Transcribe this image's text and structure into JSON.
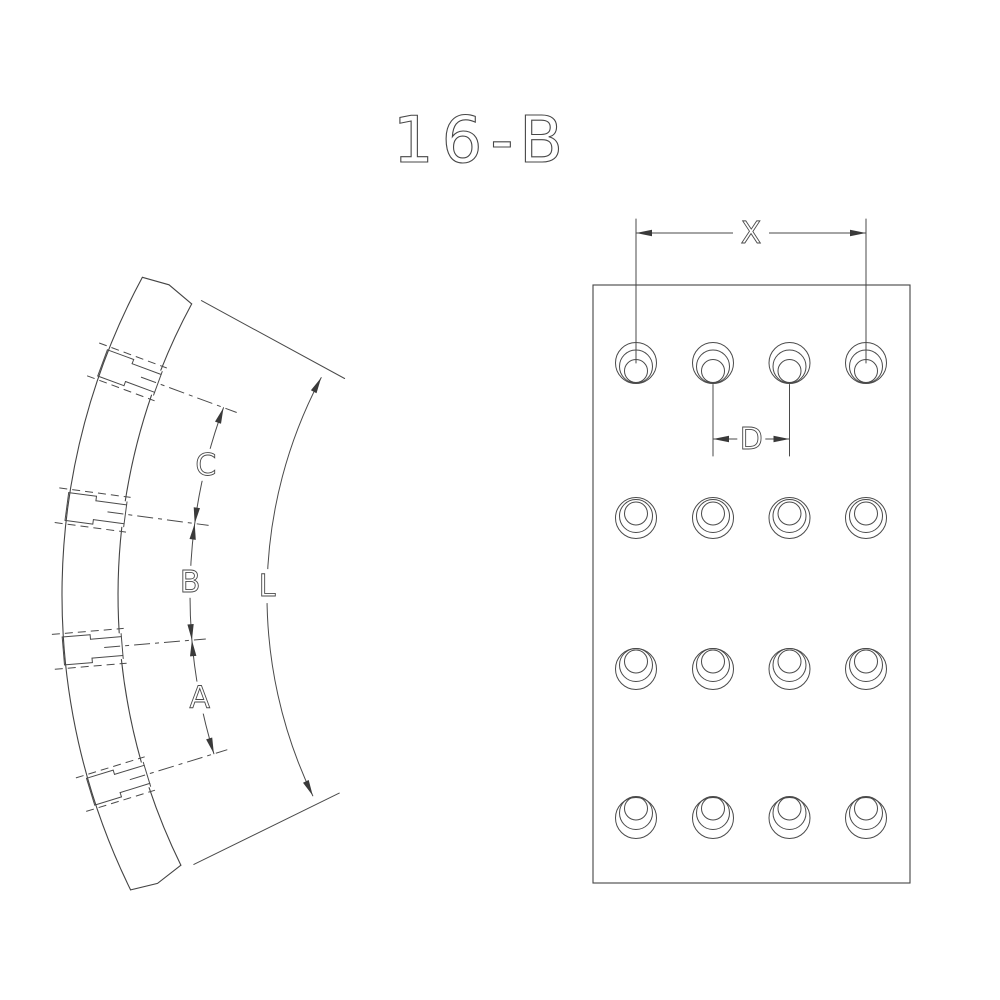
{
  "title": "16-B",
  "colors": {
    "line": "#4a4a4a",
    "arrow": "#3a3a3a",
    "background": "#ffffff"
  },
  "left_view": {
    "dim_chain": {
      "labels": [
        "C",
        "B",
        "A"
      ]
    },
    "length_dim": {
      "label": "L"
    },
    "geometry": {
      "center": [
        730,
        595
      ],
      "outer_radius": 668,
      "inner_radius": 612,
      "start_angle_deg": 153.8,
      "end_angle_deg": 208.4,
      "hole_angles_deg": [
        200.3,
        187.6,
        175.2,
        162.9
      ],
      "dim_chain_radius": 540,
      "length_dim_radius": 463,
      "counterbore_half_width": 14,
      "hole_half_width": 9.5,
      "hidden_line_half_width": 17.5,
      "step_radius": 641,
      "cap_radius": 610
    }
  },
  "right_view": {
    "dim_x": {
      "label": "X",
      "line_y": 233,
      "ext_top_y": 219
    },
    "dim_d": {
      "label": "D",
      "line_y": 439,
      "ext_bottom_y": 456
    },
    "geometry": {
      "rect": [
        593,
        285,
        317,
        598
      ],
      "columns_x": [
        636,
        713,
        789.5,
        866
      ],
      "rows_y": [
        363,
        518,
        669,
        818
      ],
      "hole_outer_r": 20.5,
      "hole_mid_r": 16.5,
      "hole_inner_r": 11.5,
      "mid_dy": [
        3.5,
        -2,
        -4,
        -5
      ],
      "inner_dy": [
        8,
        -4.5,
        -7.5,
        -9.5
      ]
    }
  }
}
